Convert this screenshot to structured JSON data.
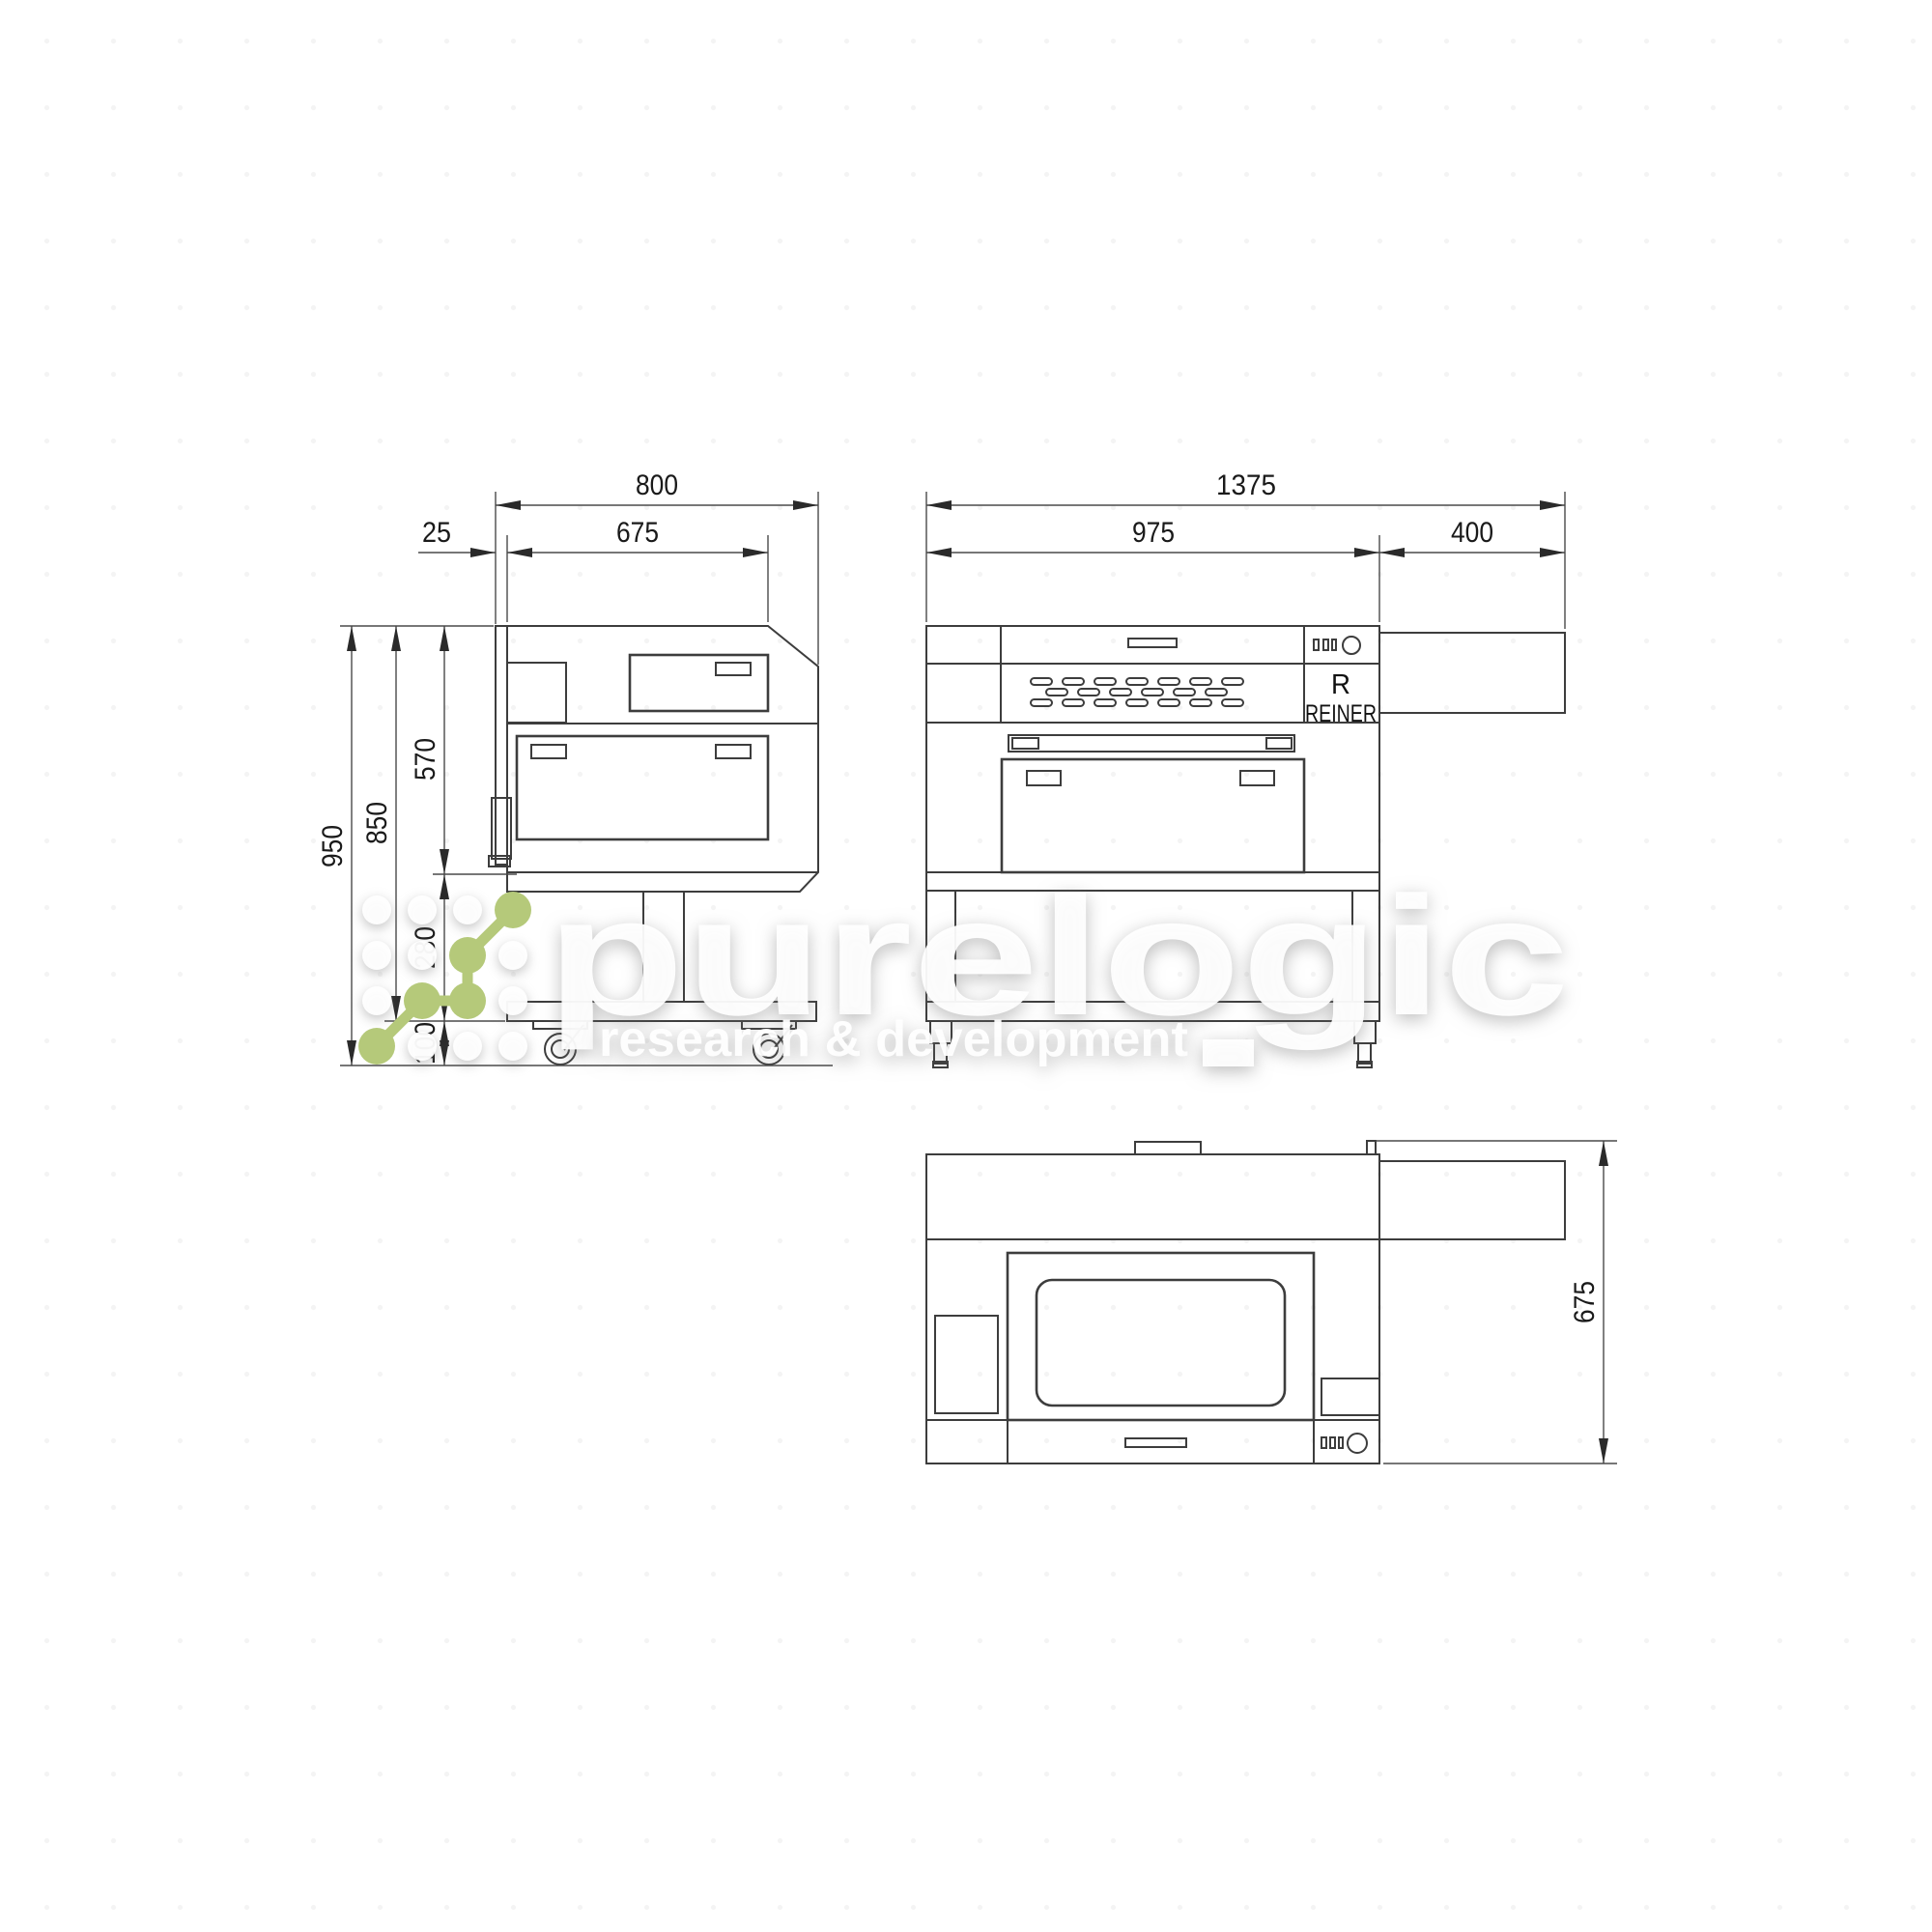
{
  "side_view": {
    "dim_overall_width": "800",
    "dim_rear_offset": "25",
    "dim_body_width": "675",
    "dim_overall_height": "950",
    "dim_height_to_casters": "850",
    "dim_body_height": "570",
    "dim_stand_height": "280",
    "dim_caster_height": "100"
  },
  "front_view": {
    "dim_overall_width": "1375",
    "dim_body_width": "975",
    "dim_tube_cover_width": "400",
    "brand_initial": "R",
    "brand_name": "REINER"
  },
  "top_view": {
    "dim_depth": "675"
  },
  "watermark": {
    "wordmark": "purelogic",
    "tagline": "research & development",
    "accent_color": "#b5c97a",
    "text_color": "#ffffff"
  }
}
